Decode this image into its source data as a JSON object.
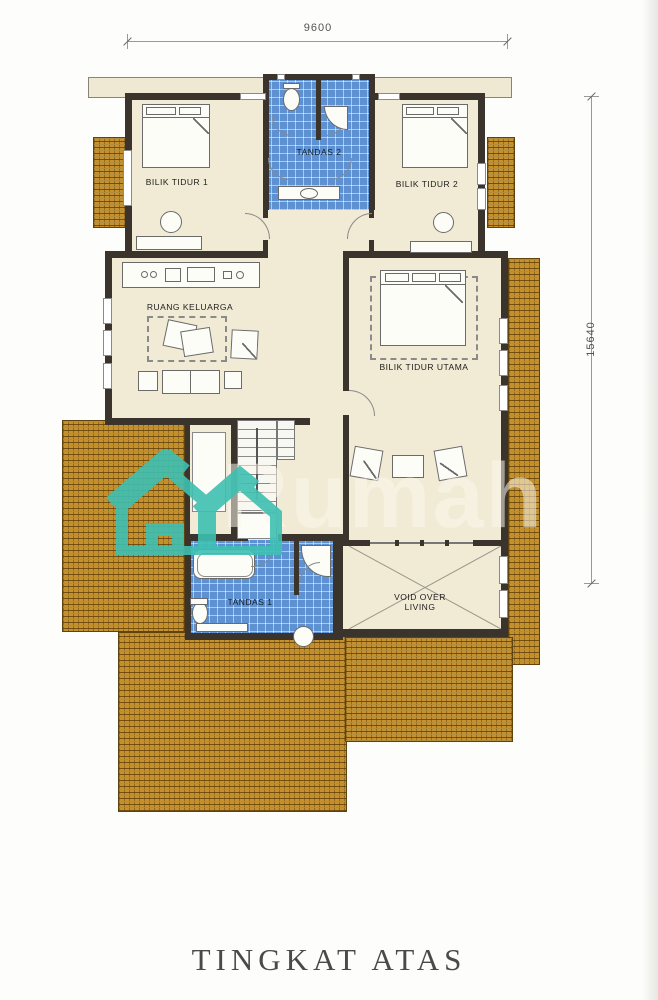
{
  "title": "TINGKAT ATAS",
  "dimensions": {
    "width_label": "9600",
    "height_label": "15640"
  },
  "rooms": {
    "bilik_tidur_1": "BILIK TIDUR 1",
    "tandas_2": "TANDAS 2",
    "bilik_tidur_2": "BILIK TIDUR 2",
    "ruang_keluarga": "RUANG KELUARGA",
    "bilik_tidur_utama": "BILIK TIDUR UTAMA",
    "tandas_1": "TANDAS 1",
    "void_line1": "VOID OVER",
    "void_line2": "LIVING"
  },
  "watermark": {
    "text": "Rumah",
    "logo": "irumah-house-logo",
    "color": "#3EC0B2"
  },
  "colors": {
    "wall": "#3A342C",
    "floor": "#F1EAD5",
    "tile_blue": "#5D91D2",
    "roof_gold": "#C6922E",
    "title_text": "#4A4A48"
  }
}
